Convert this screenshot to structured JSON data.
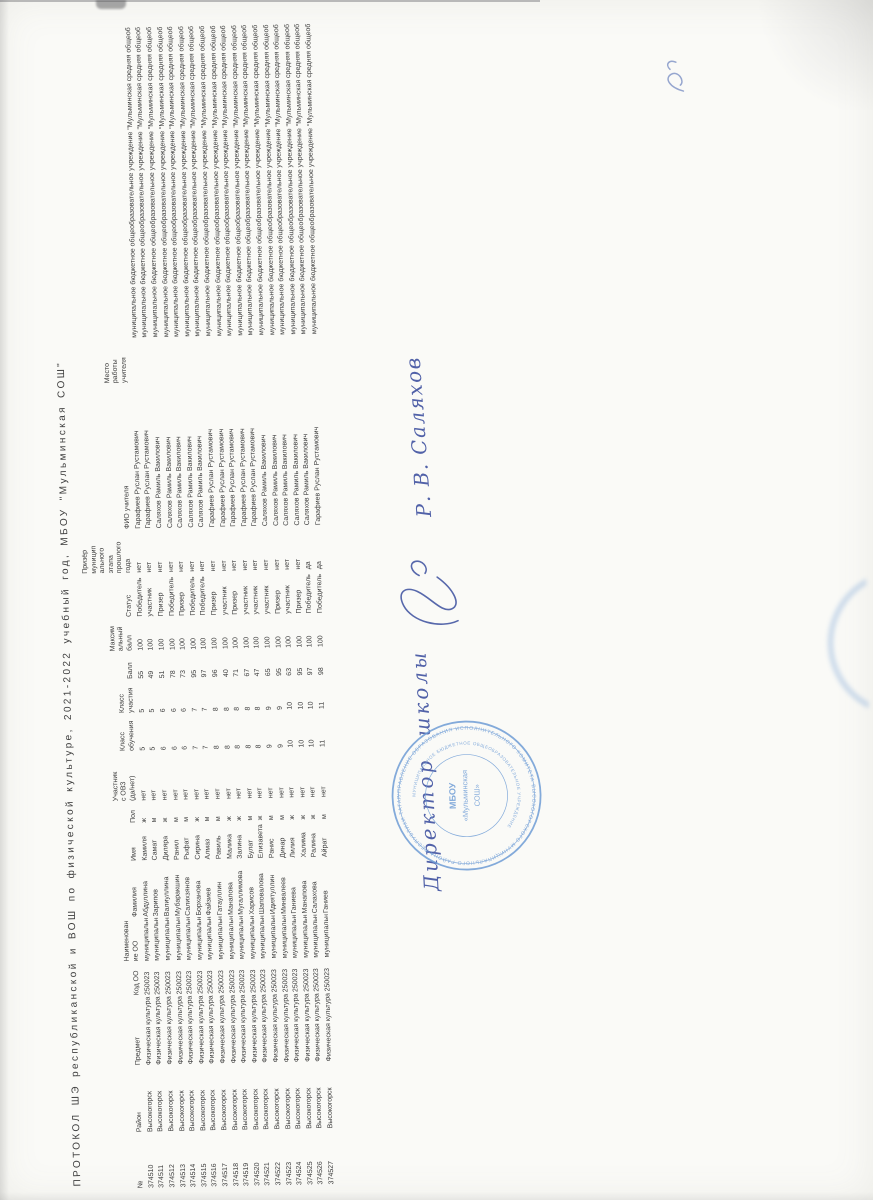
{
  "title": "ПРОТОКОЛ ШЭ республиканской и ВОШ по физической культуре, 2021-2022 учебный год, МБОУ \"Мульминская СОШ\"",
  "table": {
    "columns": [
      {
        "key": "num",
        "header_lines": [
          "№"
        ]
      },
      {
        "key": "district",
        "header_lines": [
          "Район"
        ]
      },
      {
        "key": "subject",
        "header_lines": [
          "Предмет"
        ]
      },
      {
        "key": "school_code",
        "header_lines": [
          "Код ОО"
        ]
      },
      {
        "key": "school",
        "header_lines": [
          "Наименован",
          "ие ОО"
        ]
      },
      {
        "key": "last_name",
        "header_lines": [
          "Фамилия"
        ]
      },
      {
        "key": "first_name",
        "header_lines": [
          "Имя"
        ]
      },
      {
        "key": "gender",
        "header_lines": [
          "Пол"
        ]
      },
      {
        "key": "ovz",
        "header_lines": [
          "Участник",
          "с ОВЗ",
          "(да/нет)"
        ]
      },
      {
        "key": "grade_study",
        "header_lines": [
          "Класс",
          "обучения"
        ]
      },
      {
        "key": "grade_part",
        "header_lines": [
          "Класс",
          "участия"
        ]
      },
      {
        "key": "score",
        "header_lines": [
          "Балл"
        ]
      },
      {
        "key": "max_score",
        "header_lines": [
          "Максим",
          "альный",
          "балл"
        ]
      },
      {
        "key": "status",
        "header_lines": [
          "Статус"
        ]
      },
      {
        "key": "prev_winner",
        "header_lines": [
          "Призёр",
          "муницип",
          "ального",
          "этапа",
          "прошлого",
          "года"
        ]
      },
      {
        "key": "teacher",
        "header_lines": [
          "ФИО учителя"
        ]
      },
      {
        "key": "workplace",
        "header_lines": [
          "Место",
          "работы",
          "учителя"
        ]
      }
    ],
    "rows": [
      {
        "num": "374510",
        "district": "Высокогорск",
        "subject": "Физическая культура",
        "school_code": "250023",
        "school": "муниципальн",
        "last_name": "Абдуллина",
        "first_name": "Камиля",
        "gender": "ж",
        "ovz": "нет",
        "grade_study": "5",
        "grade_part": "5",
        "score": "55",
        "max_score": "100",
        "status": "Победитель",
        "prev_winner": "нет",
        "teacher": "Гарафиев Руслан Рустамович",
        "workplace": "муниципальное бюджетное общеобразовательное учреждение \"Мульминская средняя общеоб"
      },
      {
        "num": "374511",
        "district": "Высокогорск",
        "subject": "Физическая культура",
        "school_code": "250023",
        "school": "муниципальн",
        "last_name": "Зарипов",
        "first_name": "Самат",
        "gender": "м",
        "ovz": "нет",
        "grade_study": "5",
        "grade_part": "5",
        "score": "49",
        "max_score": "100",
        "status": "участник",
        "prev_winner": "нет",
        "teacher": "Гарафиев Руслан Рустамович",
        "workplace": "муниципальное бюджетное общеобразовательное учреждение \"Мульминская средняя общеоб"
      },
      {
        "num": "374512",
        "district": "Высокогорск",
        "subject": "Физическая культура",
        "school_code": "250023",
        "school": "муниципальн",
        "last_name": "Валиуллина",
        "first_name": "Диляра",
        "gender": "ж",
        "ovz": "нет",
        "grade_study": "6",
        "grade_part": "6",
        "score": "51",
        "max_score": "100",
        "status": "Призер",
        "prev_winner": "нет",
        "teacher": "Саляхов Рамиль Вакилович",
        "workplace": "муниципальное бюджетное общеобразовательное учреждение \"Мульминская средняя общеоб"
      },
      {
        "num": "374513",
        "district": "Высокогорск",
        "subject": "Физическая культура",
        "school_code": "250023",
        "school": "муниципальн",
        "last_name": "Мубаракшин",
        "first_name": "Ранил",
        "gender": "м",
        "ovz": "нет",
        "grade_study": "6",
        "grade_part": "6",
        "score": "78",
        "max_score": "100",
        "status": "Победитель",
        "prev_winner": "нет",
        "teacher": "Саляхов Рамиль Вакилович",
        "workplace": "муниципальное бюджетное общеобразовательное учреждение \"Мульминская средняя общеоб"
      },
      {
        "num": "374514",
        "district": "Высокогорск",
        "subject": "Физическая культура",
        "school_code": "250023",
        "school": "муниципальн",
        "last_name": "Салихзянов",
        "first_name": "Рыфат",
        "gender": "м",
        "ovz": "нет",
        "grade_study": "6",
        "grade_part": "6",
        "score": "73",
        "max_score": "100",
        "status": "Призер",
        "prev_winner": "нет",
        "teacher": "Саляхов Рамиль Вакилович",
        "workplace": "муниципальное бюджетное общеобразовательное учреждение \"Мульминская средняя общеоб"
      },
      {
        "num": "374515",
        "district": "Высокогорск",
        "subject": "Физическая культура",
        "school_code": "250023",
        "school": "муниципальн",
        "last_name": "Борханова",
        "first_name": "Сирина",
        "gender": "ж",
        "ovz": "нет",
        "grade_study": "7",
        "grade_part": "7",
        "score": "95",
        "max_score": "100",
        "status": "Победитель",
        "prev_winner": "нет",
        "teacher": "Саляхов Рамиль Вакилович",
        "workplace": "муниципальное бюджетное общеобразовательное учреждение \"Мульминская средняя общеоб"
      },
      {
        "num": "374516",
        "district": "Высокогорск",
        "subject": "Физическая культура",
        "school_code": "250023",
        "school": "муниципальн",
        "last_name": "Файзиев",
        "first_name": "Алмаз",
        "gender": "м",
        "ovz": "нет",
        "grade_study": "7",
        "grade_part": "7",
        "score": "97",
        "max_score": "100",
        "status": "Победитель",
        "prev_winner": "нет",
        "teacher": "Саляхов Рамиль Вакилович",
        "workplace": "муниципальное бюджетное общеобразовательное учреждение \"Мульминская средняя общеоб"
      },
      {
        "num": "374517",
        "district": "Высокогорск",
        "subject": "Физическая культура",
        "school_code": "250023",
        "school": "муниципальн",
        "last_name": "Гатауллин",
        "first_name": "Равиль",
        "gender": "м",
        "ovz": "нет",
        "grade_study": "8",
        "grade_part": "8",
        "score": "96",
        "max_score": "100",
        "status": "Призер",
        "prev_winner": "нет",
        "teacher": "Гарафиев Руслан Рустамович",
        "workplace": "муниципальное бюджетное общеобразовательное учреждение \"Мульминская средняя общеоб"
      },
      {
        "num": "374518",
        "district": "Высокогорск",
        "subject": "Физическая культура",
        "school_code": "250023",
        "school": "муниципальн",
        "last_name": "Манапова",
        "first_name": "Малика",
        "gender": "ж",
        "ovz": "нет",
        "grade_study": "8",
        "grade_part": "8",
        "score": "40",
        "max_score": "100",
        "status": "участник",
        "prev_winner": "нет",
        "teacher": "Гарафиев Руслан Рустамович",
        "workplace": "муниципальное бюджетное общеобразовательное учреждение \"Мульминская средняя общеоб"
      },
      {
        "num": "374519",
        "district": "Высокогорск",
        "subject": "Физическая культура",
        "school_code": "250023",
        "school": "муниципальн",
        "last_name": "Мугаллимова",
        "first_name": "Залина",
        "gender": "ж",
        "ovz": "нет",
        "grade_study": "8",
        "grade_part": "8",
        "score": "71",
        "max_score": "100",
        "status": "Призер",
        "prev_winner": "нет",
        "teacher": "Гарафиев Руслан Рустамович",
        "workplace": "муниципальное бюджетное общеобразовательное учреждение \"Мульминская средняя общеоб"
      },
      {
        "num": "374520",
        "district": "Высокогорск",
        "subject": "Физическая культура",
        "school_code": "250023",
        "school": "муниципальн",
        "last_name": "Харисов",
        "first_name": "Булат",
        "gender": "м",
        "ovz": "нет",
        "grade_study": "8",
        "grade_part": "8",
        "score": "67",
        "max_score": "100",
        "status": "участник",
        "prev_winner": "нет",
        "teacher": "Гарафиев Руслан Рустамович",
        "workplace": "муниципальное бюджетное общеобразовательное учреждение \"Мульминская средняя общеоб"
      },
      {
        "num": "374521",
        "district": "Высокогорск",
        "subject": "Физическая культура",
        "school_code": "250023",
        "school": "муниципальн",
        "last_name": "Шаповалова",
        "first_name": "Елизавета",
        "gender": "ж",
        "ovz": "нет",
        "grade_study": "8",
        "grade_part": "8",
        "score": "47",
        "max_score": "100",
        "status": "участник",
        "prev_winner": "нет",
        "teacher": "Гарафиев Руслан Рустамович",
        "workplace": "муниципальное бюджетное общеобразовательное учреждение \"Мульминская средняя общеоб"
      },
      {
        "num": "374522",
        "district": "Высокогорск",
        "subject": "Физическая культура",
        "school_code": "250023",
        "school": "муниципальн",
        "last_name": "Идиятуллин",
        "first_name": "Ранис",
        "gender": "м",
        "ovz": "нет",
        "grade_study": "9",
        "grade_part": "9",
        "score": "65",
        "max_score": "100",
        "status": "участник",
        "prev_winner": "нет",
        "teacher": "Саляхов Рамиль Вакилович",
        "workplace": "муниципальное бюджетное общеобразовательное учреждение \"Мульминская средняя общеоб"
      },
      {
        "num": "374523",
        "district": "Высокогорск",
        "subject": "Физическая культура",
        "school_code": "250023",
        "school": "муниципальн",
        "last_name": "Минвалеев",
        "first_name": "Динар",
        "gender": "м",
        "ovz": "нет",
        "grade_study": "9",
        "grade_part": "9",
        "score": "95",
        "max_score": "100",
        "status": "Призер",
        "prev_winner": "нет",
        "teacher": "Саляхов Рамиль Вакилович",
        "workplace": "муниципальное бюджетное общеобразовательное учреждение \"Мульминская средняя общеоб"
      },
      {
        "num": "374524",
        "district": "Высокогорск",
        "subject": "Физическая культура",
        "school_code": "250023",
        "school": "муниципальн",
        "last_name": "Ганиева",
        "first_name": "Лилия",
        "gender": "ж",
        "ovz": "нет",
        "grade_study": "10",
        "grade_part": "10",
        "score": "63",
        "max_score": "100",
        "status": "участник",
        "prev_winner": "нет",
        "teacher": "Саляхов Рамиль Вакилович",
        "workplace": "муниципальное бюджетное общеобразовательное учреждение \"Мульминская средняя общеоб"
      },
      {
        "num": "374525",
        "district": "Высокогорск",
        "subject": "Физическая культура",
        "school_code": "250023",
        "school": "муниципальн",
        "last_name": "Манапова",
        "first_name": "Халима",
        "gender": "ж",
        "ovz": "нет",
        "grade_study": "10",
        "grade_part": "10",
        "score": "95",
        "max_score": "100",
        "status": "Призер",
        "prev_winner": "нет",
        "teacher": "Саляхов Рамиль Вакилович",
        "workplace": "муниципальное бюджетное общеобразовательное учреждение \"Мульминская средняя общеоб"
      },
      {
        "num": "374526",
        "district": "Высокогорск",
        "subject": "Физическая культура",
        "school_code": "250023",
        "school": "муниципальн",
        "last_name": "Салахова",
        "first_name": "Ралина",
        "gender": "ж",
        "ovz": "нет",
        "grade_study": "10",
        "grade_part": "10",
        "score": "97",
        "max_score": "100",
        "status": "Победитель",
        "prev_winner": "да",
        "teacher": "Саляхов Рамиль Вакилович",
        "workplace": "муниципальное бюджетное общеобразовательное учреждение \"Мульминская средняя общеоб"
      },
      {
        "num": "374527",
        "district": "Высокогорск",
        "subject": "Физическая культура",
        "school_code": "250023",
        "school": "муниципальн",
        "last_name": "Ганиев",
        "first_name": "Айрат",
        "gender": "м",
        "ovz": "нет",
        "grade_study": "11",
        "grade_part": "11",
        "score": "98",
        "max_score": "100",
        "status": "Победитель",
        "prev_winner": "да",
        "teacher": "Гарафиев Руслан Рустамович",
        "workplace": "муниципальное бюджетное общеобразовательное учреждение \"Мульминская средняя общеоб"
      }
    ]
  },
  "signature": {
    "role": "Директор школы",
    "name": "Р. В. Саляхов",
    "ink_color": "#3a4d9e"
  },
  "stamp": {
    "shape": "round",
    "color": "#6f9dd6",
    "outer_ring": "УПРАВЛЕНИЕ ОБРАЗОВАНИЯ ИСПОЛНИТЕЛЬНОГО КОМИТЕТА ВЫСОКОГОРСКОГО МУНИЦИПАЛЬНОГО РАЙОНА РЕСПУБЛИКИ ТАТАРСТАН",
    "inner_ring": "МУНИЦИПАЛЬНОЕ БЮДЖЕТНОЕ ОБЩЕОБРАЗОВАТЕЛЬНОЕ УЧРЕЖДЕНИЕ",
    "center_lines": [
      "МБОУ",
      "«Мульминская",
      "СОШ»"
    ]
  }
}
